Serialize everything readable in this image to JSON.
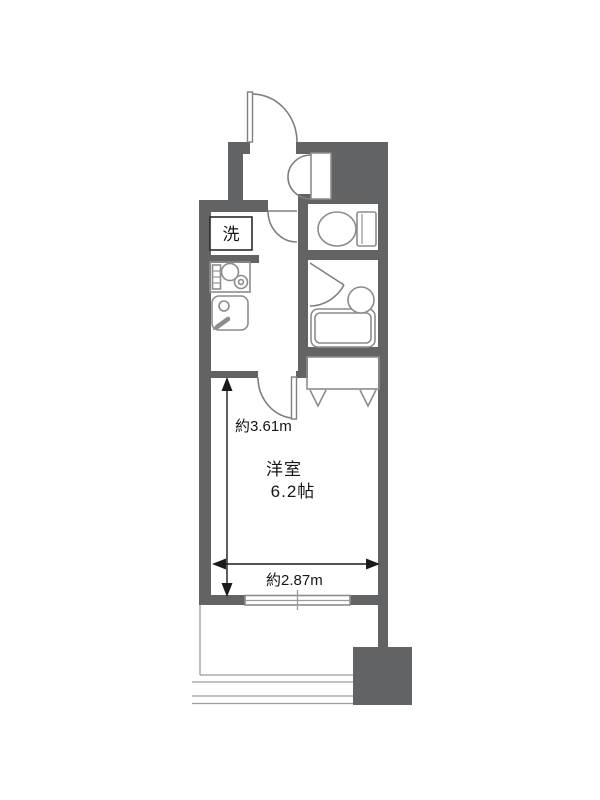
{
  "plan": {
    "type": "apartment-floorplan",
    "labels": {
      "laundry": "洗",
      "room_name": "洋室",
      "room_size": "6.2帖",
      "dim_vertical": "約3.61m",
      "dim_horizontal": "約2.87m"
    },
    "fixtures": [
      "entrance-door",
      "shoe-cabinet",
      "washing-machine-space",
      "kitchen-stove",
      "kitchen-sink",
      "hall-door",
      "toilet",
      "bathroom-door",
      "wash-basin",
      "bathtub",
      "room-door",
      "closet-hanger",
      "sliding-window",
      "balcony-railing",
      "corner-block"
    ],
    "colors": {
      "wall": "#616365",
      "fixture_line": "#8c8c8c",
      "dimension_line": "#1a1a1a",
      "text": "#161616",
      "background": "#ffffff"
    }
  }
}
